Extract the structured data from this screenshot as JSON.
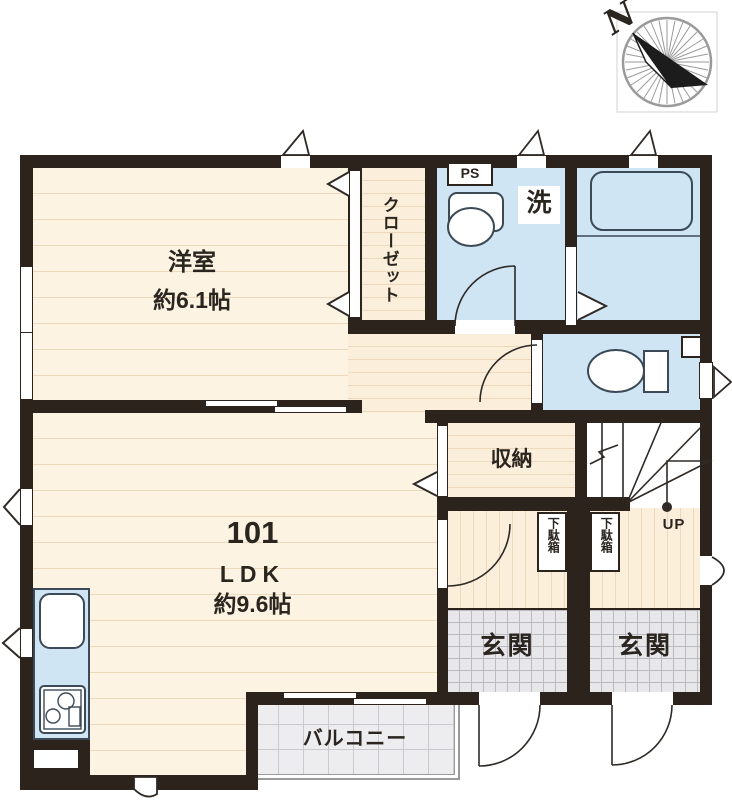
{
  "compass": {
    "north": "N"
  },
  "plan": {
    "unit_number": "101",
    "ldk": {
      "type": "LDK",
      "size": "約9.6帖"
    },
    "western_room": {
      "name": "洋室",
      "size": "約6.1帖"
    },
    "closet": {
      "label": "クローゼット"
    },
    "pipe_space": {
      "label": "PS"
    },
    "laundry": {
      "label": "洗"
    },
    "storage": {
      "label": "収納"
    },
    "shoe_box": {
      "label": "下駄箱"
    },
    "entrance": {
      "label": "玄関"
    },
    "balcony": {
      "label": "バルコニー"
    },
    "stairs": {
      "up_label": "UP"
    }
  },
  "colors": {
    "wall": "#2d231d",
    "flooring": "#fdf3e2",
    "flooring_line": "#ecd9bc",
    "wet_area": "#cfe5f3",
    "fixture_line": "#3c4a57",
    "entrance_tile": "#e7e7ea",
    "balcony_tile": "#ededef"
  }
}
